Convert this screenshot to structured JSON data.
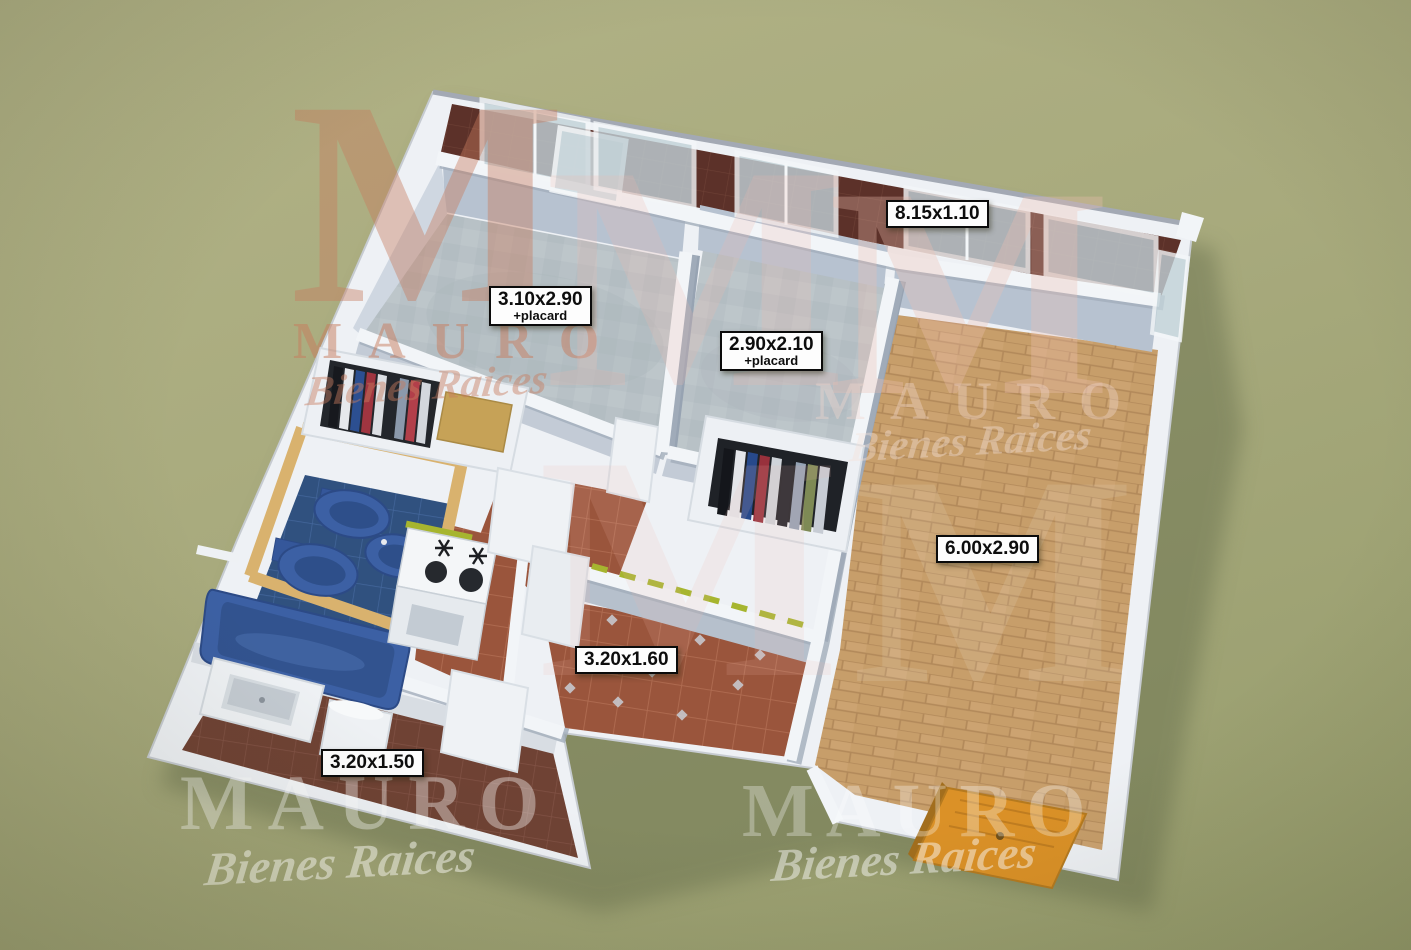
{
  "scene": {
    "description": "3D axonometric render of an apartment floor plan on an olive background",
    "render_style": "3d-floor-plan"
  },
  "watermark": {
    "letter": "M",
    "brand": "MAURO",
    "tagline": "Bienes Raices"
  },
  "labels": [
    {
      "room": "balcony",
      "text": "8.15x1.10",
      "sub": ""
    },
    {
      "room": "bedroom-1",
      "text": "3.10x2.90",
      "sub": "+placard"
    },
    {
      "room": "bedroom-2",
      "text": "2.90x2.10",
      "sub": "+placard"
    },
    {
      "room": "living-room",
      "text": "6.00x2.90",
      "sub": ""
    },
    {
      "room": "hall-kitchen",
      "text": "3.20x1.60",
      "sub": ""
    },
    {
      "room": "laundry",
      "text": "3.20x1.50",
      "sub": ""
    }
  ],
  "colors": {
    "background": "#a8aa7d",
    "building_shadow": "#6b724f",
    "wall_white": "#eef1f5",
    "wall_face": "#b7c2d0",
    "wall_cap_tan": "#d9b26e",
    "bedroom_floor": "#b8c1c6",
    "living_floor": "#c79e6a",
    "hall_floor": "#9a553c",
    "bath_floor": "#30517f",
    "laundry_floor": "#6f4234",
    "balcony_floor": "#5c3129",
    "bath_fixture_blue": "#3c60a4",
    "entrance_door_wood": "#db9127",
    "kitchen_accent_green": "#a6b52f",
    "label_bg": "#fdfdfd",
    "label_border": "#0b0b0b",
    "watermark_salmon": "#c87c5e"
  }
}
